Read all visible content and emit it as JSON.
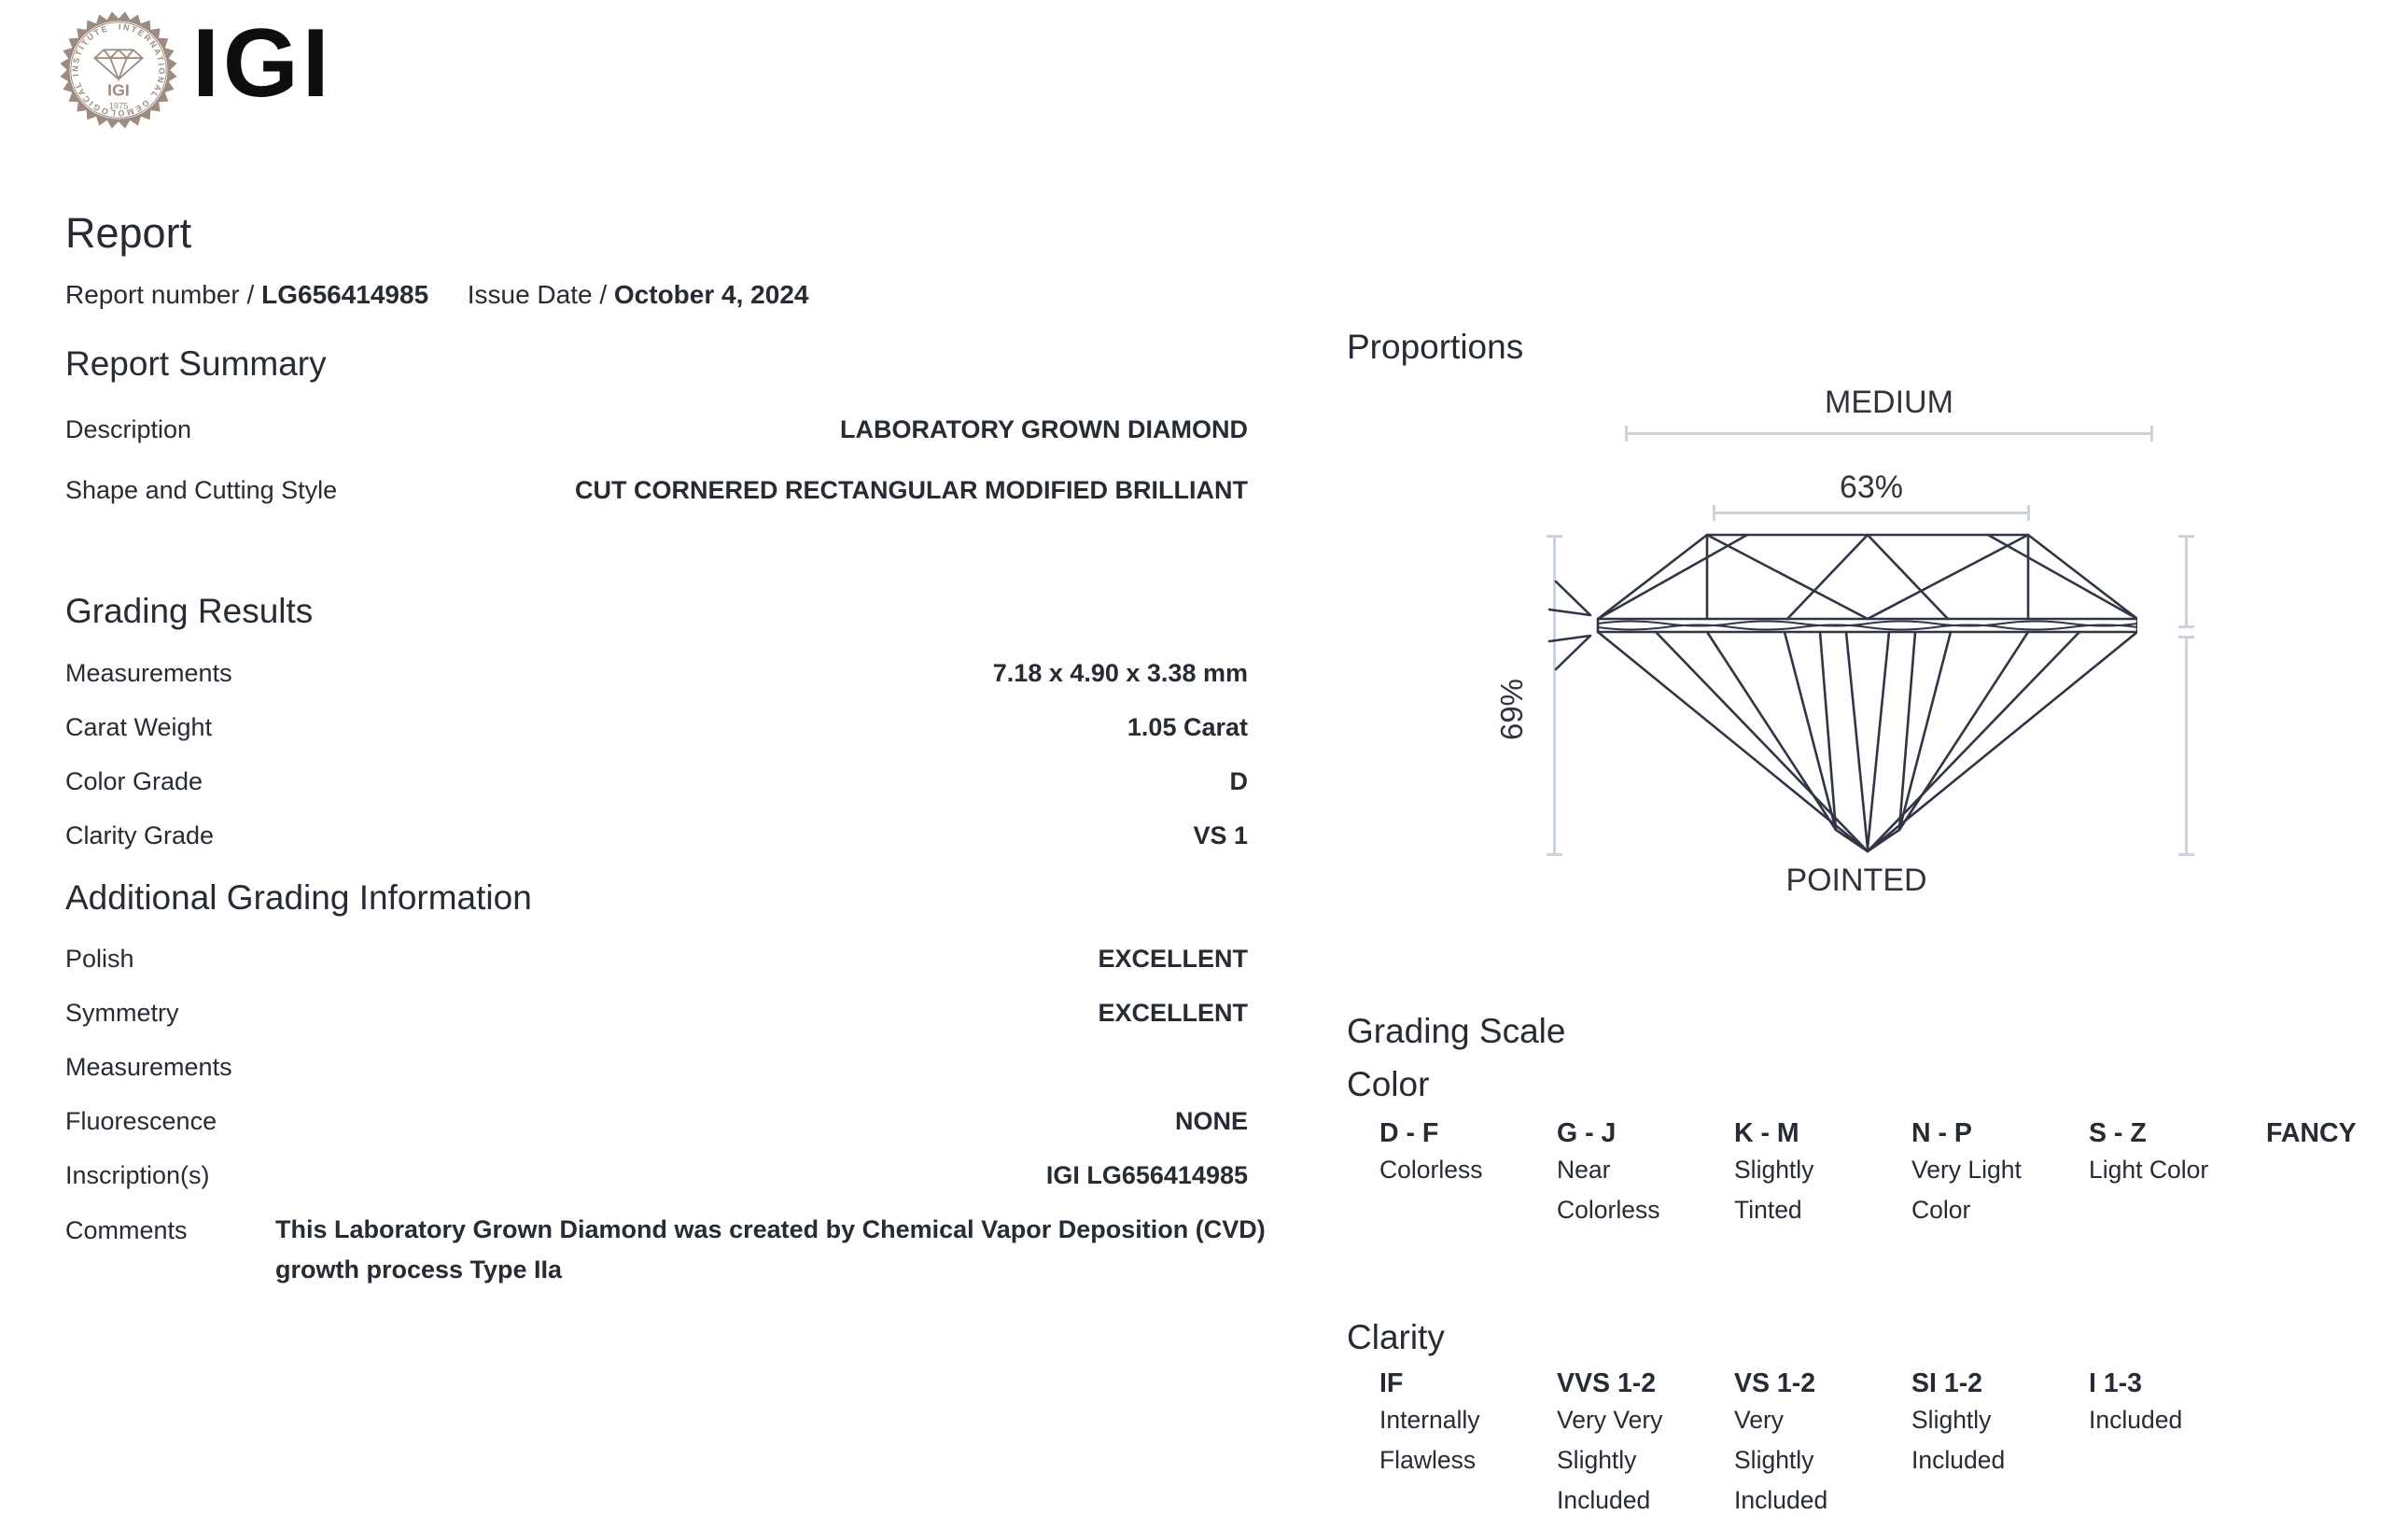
{
  "colors": {
    "ink": "#262b34",
    "seal_taupe": "#9c8b7e",
    "measure_line": "#ccd2da",
    "diamond_line": "#303645",
    "wordmark_black": "#0d0e10"
  },
  "brand": {
    "wordmark": "IGI",
    "seal_ring_text": "INTERNATIONAL GEMOLOGICAL INSTITUTE",
    "seal_monogram": "IGI",
    "seal_year": "1975"
  },
  "header": {
    "title": "Report",
    "report_number_label": "Report number /",
    "report_number": "LG656414985",
    "issue_date_label": "Issue Date /",
    "issue_date": "October 4, 2024"
  },
  "report_summary": {
    "heading": "Report Summary",
    "rows": [
      {
        "label": "Description",
        "value": "LABORATORY GROWN DIAMOND"
      },
      {
        "label": "Shape and Cutting Style",
        "value": "CUT CORNERED RECTANGULAR MODIFIED BRILLIANT"
      }
    ]
  },
  "grading_results": {
    "heading": "Grading Results",
    "rows": [
      {
        "label": "Measurements",
        "value": "7.18 x 4.90 x 3.38 mm"
      },
      {
        "label": "Carat Weight",
        "value": "1.05 Carat"
      },
      {
        "label": "Color Grade",
        "value": "D"
      },
      {
        "label": "Clarity Grade",
        "value": "VS 1"
      }
    ]
  },
  "additional_grading": {
    "heading": "Additional Grading Information",
    "rows": [
      {
        "label": "Polish",
        "value": "EXCELLENT"
      },
      {
        "label": "Symmetry",
        "value": "EXCELLENT"
      },
      {
        "label": "Measurements",
        "value": ""
      },
      {
        "label": "Fluorescence",
        "value": "NONE"
      },
      {
        "label": "Inscription(s)",
        "value": "IGI LG656414985"
      }
    ],
    "comments_label": "Comments",
    "comments_text": "This Laboratory Grown Diamond was created by Chemical Vapor Deposition (CVD) growth process Type IIa"
  },
  "proportions": {
    "heading": "Proportions",
    "girdle_thickness": "MEDIUM",
    "table_percent": "63%",
    "total_depth_percent": "69%",
    "culet": "POINTED"
  },
  "grading_scale": {
    "heading": "Grading Scale",
    "color_heading": "Color",
    "color_items": [
      {
        "grade": "D - F",
        "lines": [
          "Colorless"
        ]
      },
      {
        "grade": "G - J",
        "lines": [
          "Near",
          "Colorless"
        ]
      },
      {
        "grade": "K - M",
        "lines": [
          "Slightly",
          "Tinted"
        ]
      },
      {
        "grade": "N - P",
        "lines": [
          "Very Light",
          "Color"
        ]
      },
      {
        "grade": "S - Z",
        "lines": [
          "Light Color"
        ]
      },
      {
        "grade": "FANCY",
        "lines": []
      }
    ],
    "clarity_heading": "Clarity",
    "clarity_items": [
      {
        "grade": "IF",
        "lines": [
          "Internally",
          "Flawless"
        ]
      },
      {
        "grade": "VVS 1-2",
        "lines": [
          "Very Very",
          "Slightly",
          "Included"
        ]
      },
      {
        "grade": "VS 1-2",
        "lines": [
          "Very",
          "Slightly",
          "Included"
        ]
      },
      {
        "grade": "SI 1-2",
        "lines": [
          "Slightly",
          "Included"
        ]
      },
      {
        "grade": "I 1-3",
        "lines": [
          "Included"
        ]
      }
    ]
  }
}
